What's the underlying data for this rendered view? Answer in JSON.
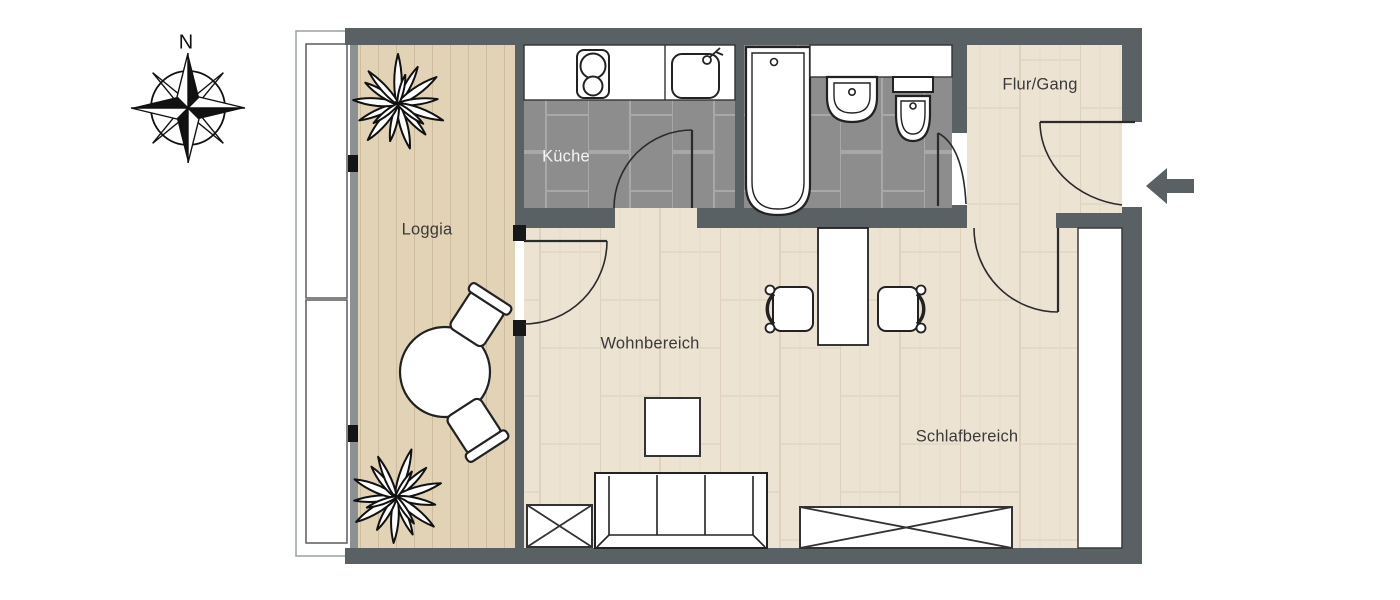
{
  "document": {
    "type": "apartment-floor-plan"
  },
  "compass": {
    "north_label": "N"
  },
  "rooms": {
    "loggia": {
      "label": "Loggia"
    },
    "kitchen": {
      "label": "Küche"
    },
    "hallway": {
      "label": "Flur/Gang"
    },
    "living": {
      "label": "Wohnbereich"
    },
    "sleeping": {
      "label": "Schlafbereich"
    }
  },
  "fixtures": [
    "stove",
    "kitchen-sink",
    "bathtub",
    "washbasin",
    "toilet",
    "round-table",
    "two-loggia-chairs",
    "two-plants",
    "desk",
    "two-desk-chairs",
    "sofa",
    "coffee-table",
    "crossed-cabinet",
    "crossed-bed",
    "wardrobe-strip"
  ],
  "entrance": {
    "indicator": "arrow-left-into-flat"
  },
  "colors": {
    "wall": "#5a6165",
    "tile_floor": "#8d8d8d",
    "tile_grout": "#a8a8a8",
    "wood_floor": "#ece3d3",
    "wood_line": "#d9cdb8",
    "deck_floor": "#e2d2b6",
    "deck_line": "#c6b394",
    "fixture_outline": "#222222",
    "label_dark": "#3a3a3a",
    "label_light": "#f4f4f4",
    "arrow": "#5a6165"
  }
}
